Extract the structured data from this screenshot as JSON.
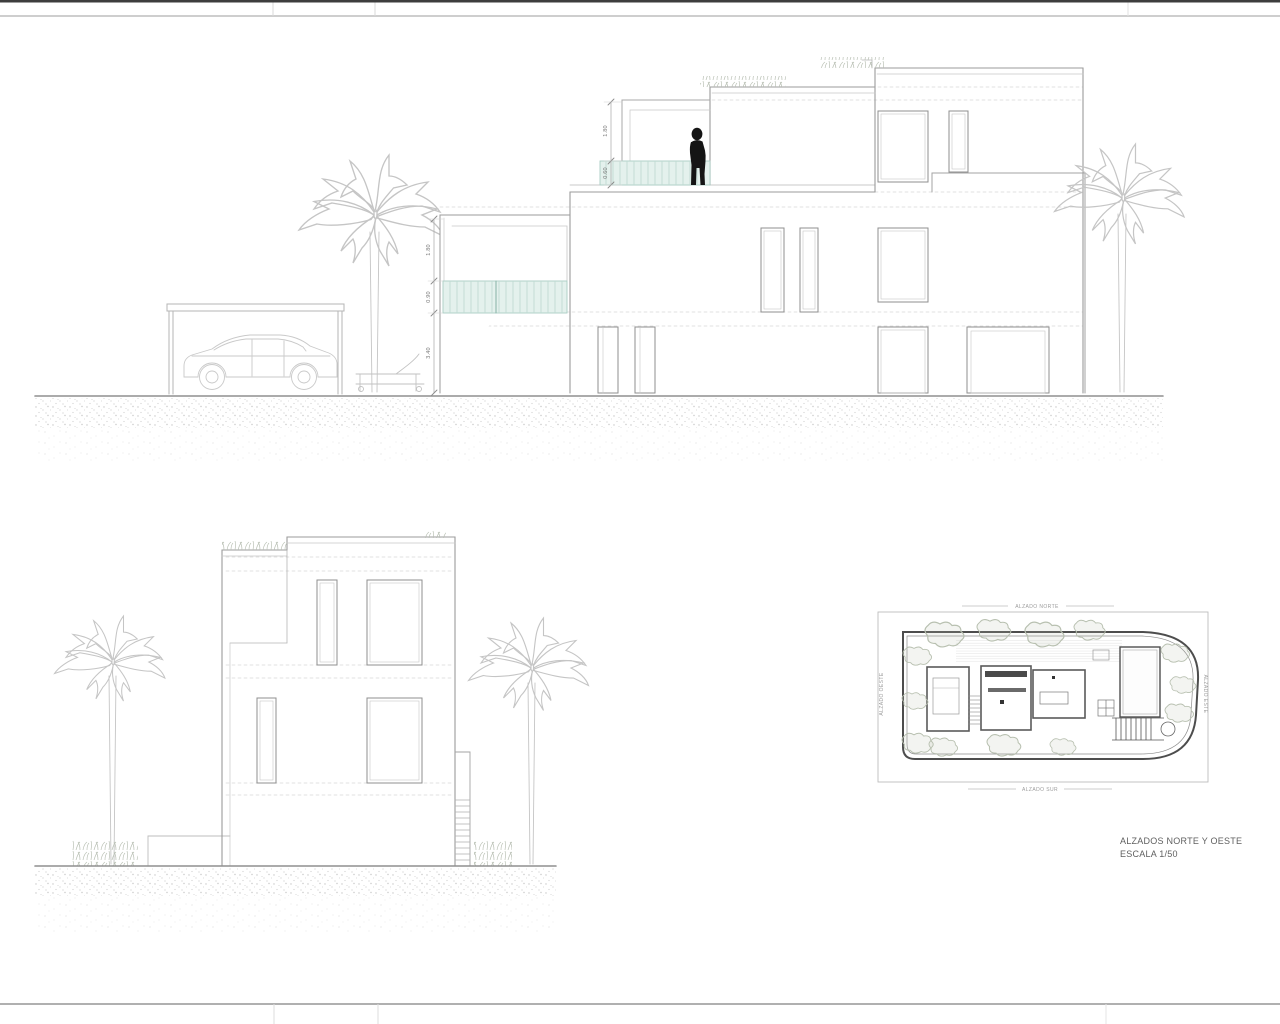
{
  "title_block": {
    "line1": "ALZADOS NORTE Y OESTE",
    "line2": "ESCALA 1/50"
  },
  "west_elevation": {
    "dim_labels": {
      "terrace_height": "1.80",
      "terrace_rail": "0.60",
      "balcony_height": "1.80",
      "balcony_rail": "0.90",
      "lower_wall": "3.40"
    }
  },
  "site_plan": {
    "labels": {
      "north": "ALZADO NORTE",
      "south": "ALZADO SUR",
      "east": "ALZADO ESTE",
      "west": "ALZADO OESTE"
    }
  },
  "colors": {
    "line_light": "#c5c5c5",
    "line_mid": "#9b9b9b",
    "line_dark": "#4d4d4d",
    "glass_rail_fill": "#e4f1ed",
    "glass_rail_stroke": "#a9cec4",
    "silhouette": "#151515",
    "text": "#5f5f5f"
  }
}
